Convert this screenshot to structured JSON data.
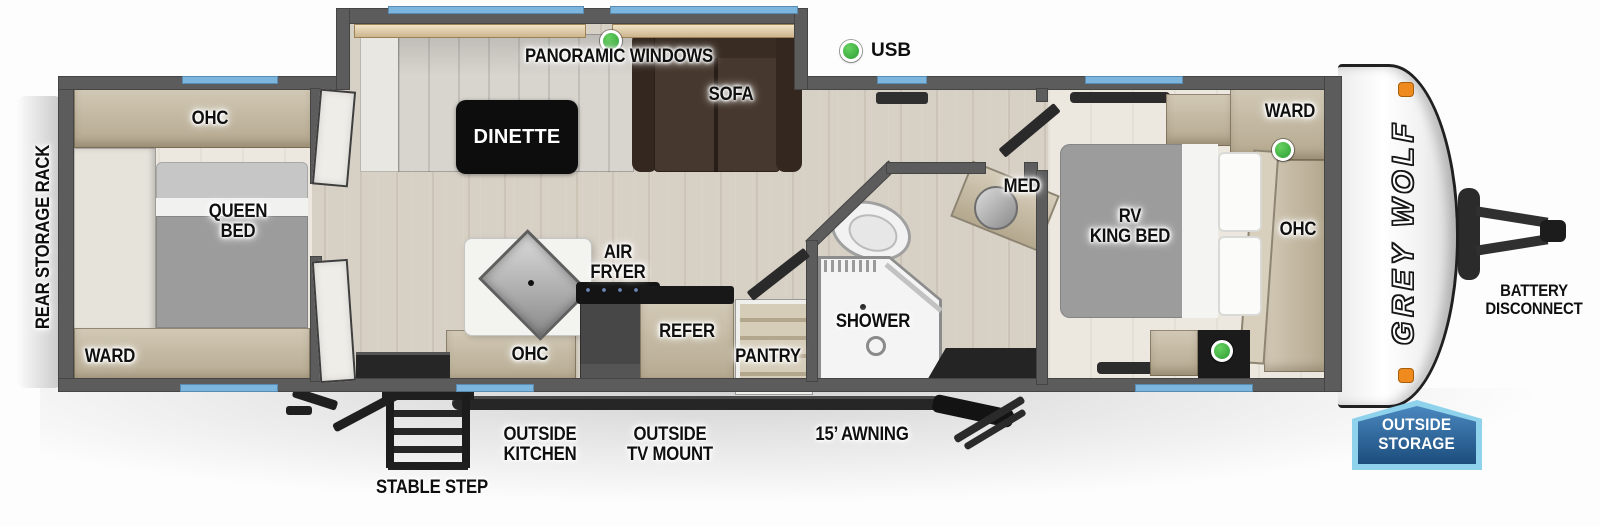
{
  "brand": {
    "logo": "GREY WOLF"
  },
  "legend": {
    "usb": "USB"
  },
  "callouts": {
    "panoramic_windows": "PANORAMIC WINDOWS",
    "awning": "15’ AWNING",
    "outside_kitchen": "OUTSIDE\nKITCHEN",
    "outside_tv_mount": "OUTSIDE\nTV MOUNT",
    "stable_step": "STABLE STEP",
    "battery_disconnect": "BATTERY\nDISCONNECT",
    "outside_storage": "OUTSIDE\nSTORAGE",
    "rear_storage_rack": "REAR STORAGE RACK"
  },
  "rooms": {
    "rear_bedroom": {
      "ohc": "OHC",
      "queen_bed": "QUEEN\nBED",
      "ward": "WARD"
    },
    "living": {
      "dinette": "DINETTE",
      "sofa": "SOFA"
    },
    "kitchen": {
      "air_fryer": "AIR\nFRYER",
      "ohc": "OHC",
      "refer": "REFER",
      "pantry": "PANTRY"
    },
    "bathroom": {
      "shower": "SHOWER",
      "med": "MED"
    },
    "front_bedroom": {
      "rv_king_bed": "RV\nKING BED",
      "ward": "WARD",
      "ohc": "OHC"
    }
  },
  "colors": {
    "window_blue": "#7cb5de",
    "usb_green": "#3fae3f",
    "wall_gray": "#5c5c5c",
    "floor_wood": "#d7d0c5",
    "cabinet_tan": "#c3b8a2",
    "sofa_brown": "#46382e",
    "bed_gray": "#9c9c9c",
    "badge_light_blue": "#8fd2ec",
    "badge_dark_blue": "#1c4e7d",
    "marker_orange": "#ef8a1f"
  }
}
